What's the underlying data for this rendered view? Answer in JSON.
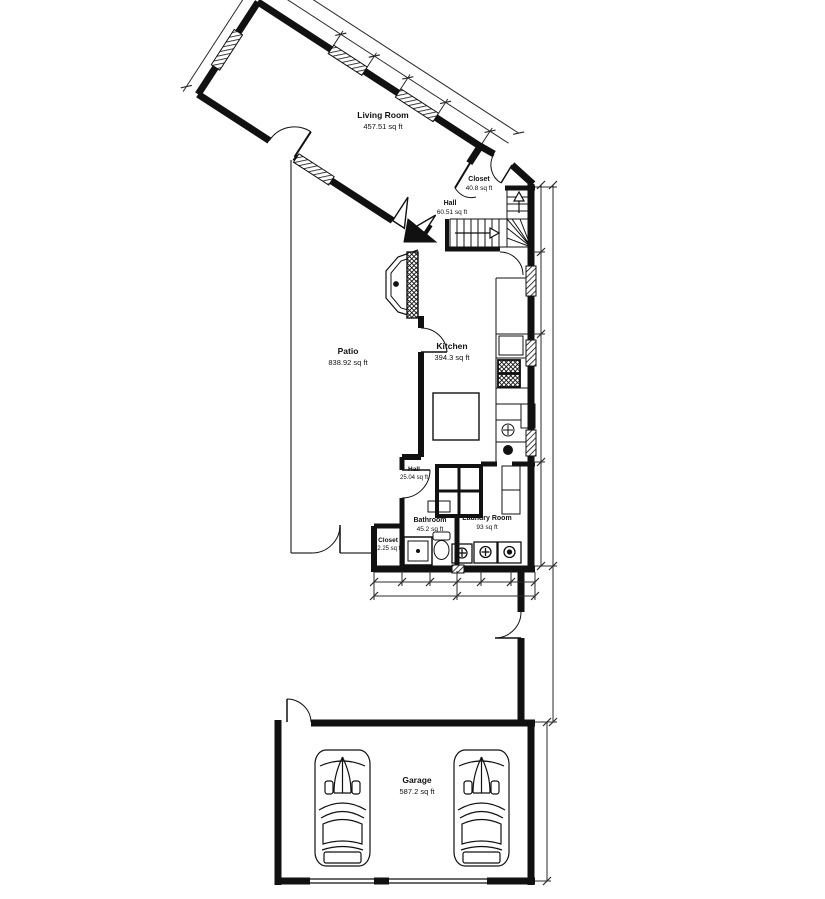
{
  "colors": {
    "wall": "#111111",
    "thin_line": "#2b2b2b",
    "background": "#ffffff"
  },
  "rooms": [
    {
      "id": "living-room",
      "name": "Living Room",
      "area": "457.51 sq ft"
    },
    {
      "id": "closet-upper",
      "name": "Closet",
      "area": "40.8 sq ft"
    },
    {
      "id": "hall-upper",
      "name": "Hall",
      "area": "60.51 sq ft"
    },
    {
      "id": "kitchen",
      "name": "Kitchen",
      "area": "394.3 sq ft"
    },
    {
      "id": "patio",
      "name": "Patio",
      "area": "838.92 sq ft"
    },
    {
      "id": "hall-lower",
      "name": "Hall",
      "area": "25.04 sq ft"
    },
    {
      "id": "bathroom",
      "name": "Bathroom",
      "area": "45.2 sq ft"
    },
    {
      "id": "laundry-room",
      "name": "Laundry Room",
      "area": "93 sq ft"
    },
    {
      "id": "closet-lower",
      "name": "Closet",
      "area": "12.25 sq ft"
    },
    {
      "id": "garage",
      "name": "Garage",
      "area": "587.2 sq ft"
    }
  ]
}
